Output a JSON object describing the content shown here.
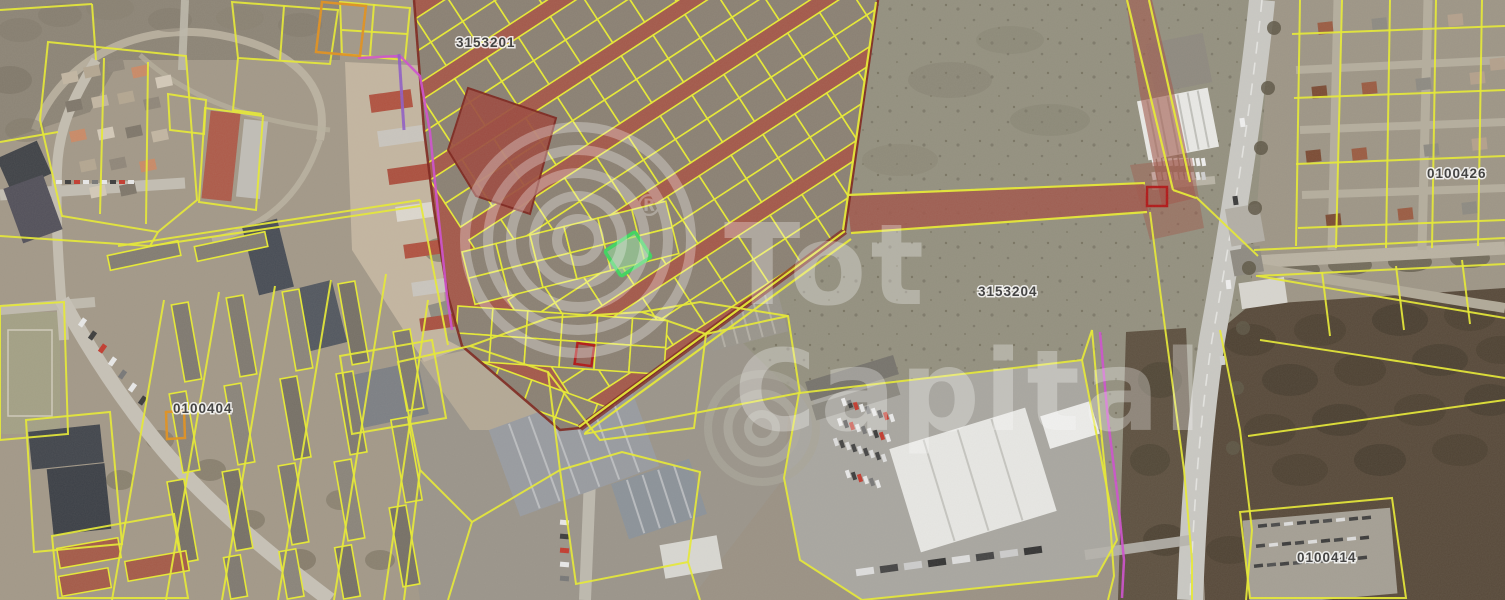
{
  "map": {
    "description": "satellite cadastral map with parcel overlay",
    "watermark": {
      "word1": "Tot",
      "word2": "Capital",
      "registered": "®"
    },
    "parcel_labels": [
      {
        "text": "3153201"
      },
      {
        "text": "3153204"
      },
      {
        "text": "0100404"
      },
      {
        "text": "0100414"
      },
      {
        "text": "0100426"
      }
    ],
    "legend_colors": {
      "parcel_line": "#e7ea33",
      "zone_overlay": "#a3584a",
      "zone_street": "#9c4a40",
      "zone_border": "#7c231c",
      "selected_parcel_stroke": "#3fd45f",
      "selected_parcel_fill": "#96e6a0",
      "boundary_magenta": "#cf4fd0",
      "boundary_purple": "#8f5cc5",
      "boundary_orange": "#e2901d",
      "flag_red": "#b01818",
      "label_text": "#3d3d3d",
      "watermark": "#ffffff"
    }
  }
}
